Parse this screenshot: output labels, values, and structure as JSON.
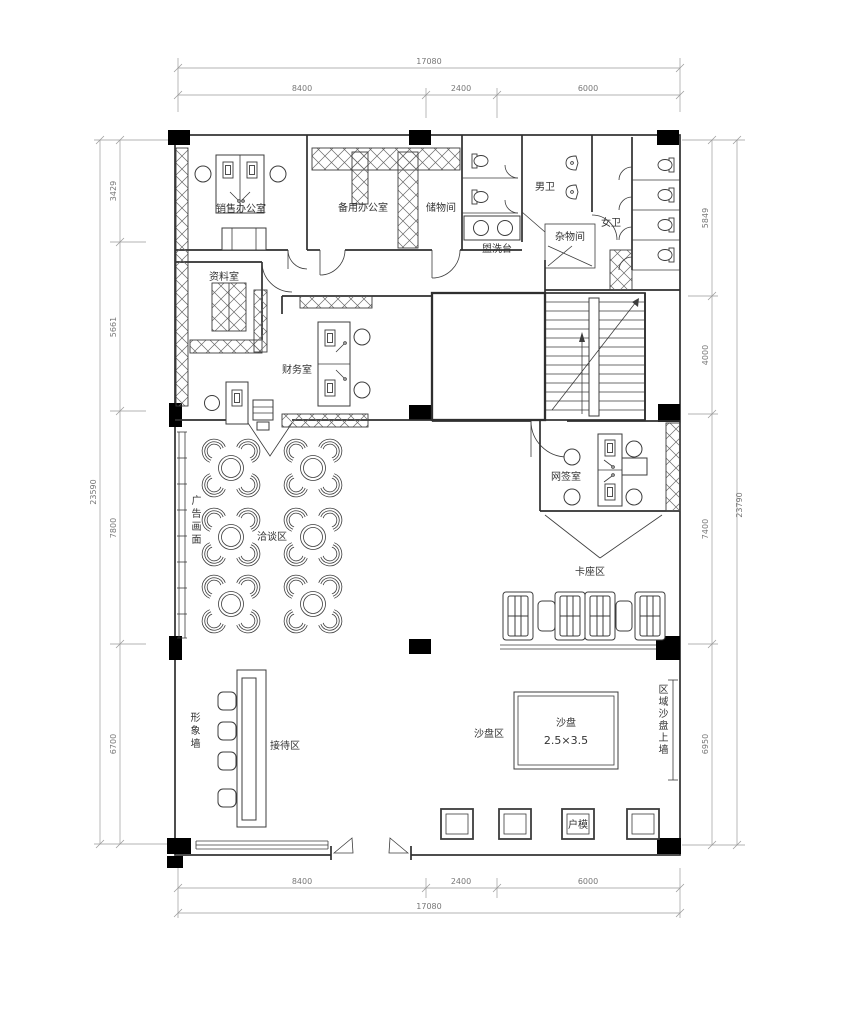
{
  "drawing": {
    "type": "sales-office-floor-plan",
    "rooms": {
      "sales_office": "销售办公室",
      "backup_office": "备用办公室",
      "storage": "储物间",
      "wash_counter": "盥洗台",
      "mens_wc": "男卫",
      "sundries": "杂物间",
      "womens_wc": "女卫",
      "archive": "资料室",
      "finance": "财务室",
      "ad_wall": "广告画面",
      "negotiation": "洽谈区",
      "signing": "网签室",
      "booth": "卡座区",
      "image_wall": "形象墙",
      "reception": "接待区",
      "sand_area": "沙盘区",
      "sand_table": "沙盘",
      "sand_size": "2.5×3.5",
      "unit_model": "户模",
      "regional_wall": "区域沙盘上墙"
    },
    "dimensions": {
      "top": {
        "total": "17080",
        "segments": [
          "8400",
          "2400",
          "6000"
        ]
      },
      "bottom": {
        "total": "17080",
        "segments": [
          "8400",
          "2400",
          "6000"
        ]
      },
      "left": {
        "total": "23590",
        "segments": [
          "3429",
          "5661",
          "7800",
          "6700"
        ]
      },
      "right": {
        "total": "23790",
        "segments": [
          "5849",
          "4000",
          "7400",
          "6950"
        ]
      }
    }
  }
}
